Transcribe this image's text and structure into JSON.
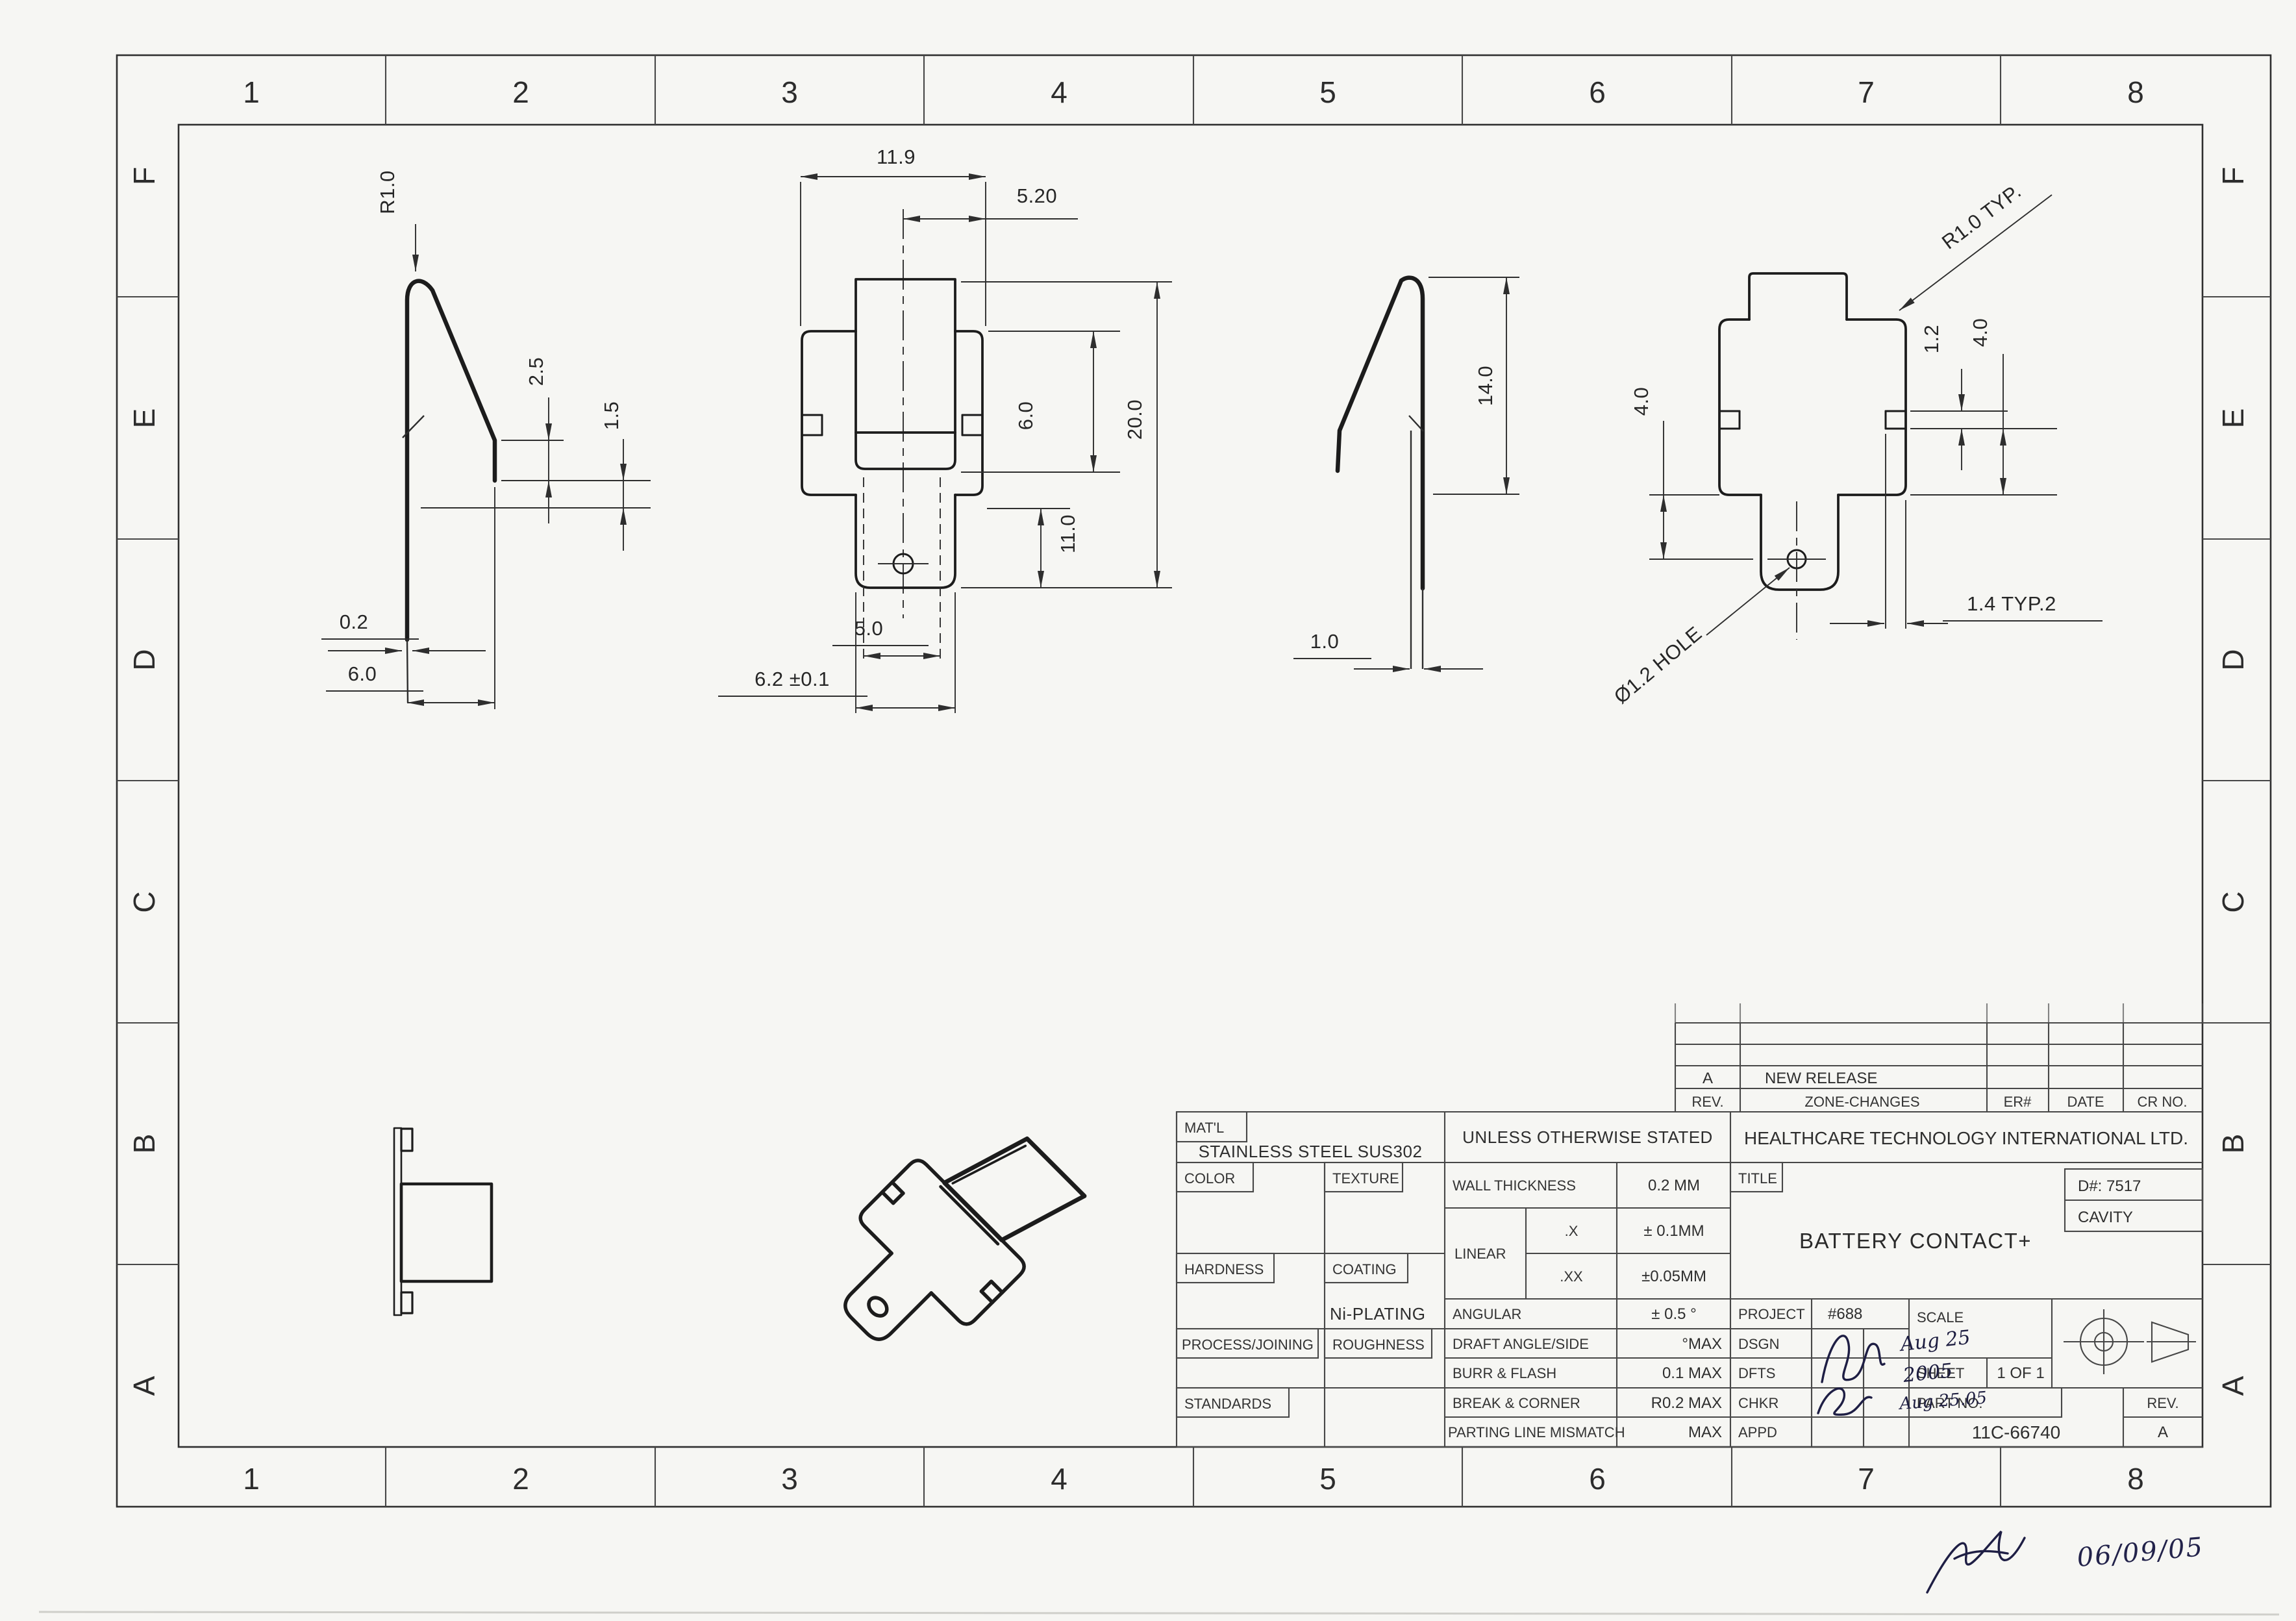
{
  "page": {
    "background": "#f6f6f3",
    "line_color": "#2e2e2e"
  },
  "zones": {
    "cols": [
      "1",
      "2",
      "3",
      "4",
      "5",
      "6",
      "7",
      "8"
    ],
    "rows": [
      "F",
      "E",
      "D",
      "C",
      "B",
      "A"
    ]
  },
  "dims": {
    "side_left": {
      "radius": "R1.0",
      "seg_a": "2.5",
      "seg_b": "1.5",
      "thickness": "0.2",
      "depth": "6.0"
    },
    "front": {
      "width": "11.9",
      "half_width": "5.20",
      "height": "20.0",
      "upper": "6.0",
      "lower": "11.0",
      "tab": "5.0",
      "base": "6.2 ±0.1"
    },
    "side_right": {
      "height": "14.0",
      "gap": "1.0"
    },
    "back": {
      "radius": "R1.0 TYP.",
      "offset_left": "4.0",
      "slot": "1.2",
      "offset_right": "4.0",
      "hole": "Ø1.2 HOLE",
      "edge": "1.4 TYP.2"
    }
  },
  "title_block": {
    "matl_label": "MAT'L",
    "material": "STAINLESS STEEL SUS302",
    "color_label": "COLOR",
    "texture_label": "TEXTURE",
    "hardness_label": "HARDNESS",
    "coating_label": "COATING",
    "coating_value": "Ni-PLATING",
    "process_label": "PROCESS/JOINING",
    "roughness_label": "ROUGHNESS",
    "standards_label": "STANDARDS",
    "uos": "UNLESS OTHERWISE STATED",
    "wall_label": "WALL THICKNESS",
    "wall_value": "0.2 MM",
    "linear_label": "LINEAR",
    "x_label": ".X",
    "x_value": "± 0.1MM",
    "xx_label": ".XX",
    "xx_value": "±0.05MM",
    "angular_label": "ANGULAR",
    "angular_value": "± 0.5 °",
    "draft_label": "DRAFT ANGLE/SIDE",
    "draft_value": "°MAX",
    "burr_label": "BURR & FLASH",
    "burr_value": "0.1 MAX",
    "break_label": "BREAK & CORNER",
    "break_value": "R0.2 MAX",
    "parting_label": "PARTING LINE MISMATCH",
    "parting_value": "MAX",
    "company": "HEALTHCARE TECHNOLOGY INTERNATIONAL LTD.",
    "title_label": "TITLE",
    "title": "BATTERY CONTACT+",
    "d_number": "D#: 7517",
    "cavity": "CAVITY",
    "project_label": "PROJECT",
    "project_value": "#688",
    "dsgn_label": "DSGN",
    "dfts_label": "DFTS",
    "chkr_label": "CHKR",
    "appd_label": "APPD",
    "scale_label": "SCALE",
    "sheet_label": "SHEET",
    "sheet_value": "1 OF 1",
    "part_no_label": "PART NO.",
    "part_no": "11C-66740",
    "rev_label": "REV.",
    "rev": "A"
  },
  "revision_table": {
    "rev_header": "REV.",
    "zone_header": "ZONE-CHANGES",
    "er_header": "ER#",
    "date_header": "DATE",
    "cr_header": "CR NO.",
    "entry_rev": "A",
    "entry_change": "NEW RELEASE"
  },
  "handwritten": {
    "dsgn_date": "Aug 25",
    "dfts_date": "2005",
    "chkr_date": "Aug 25.05",
    "release_date": "06/09/05"
  }
}
